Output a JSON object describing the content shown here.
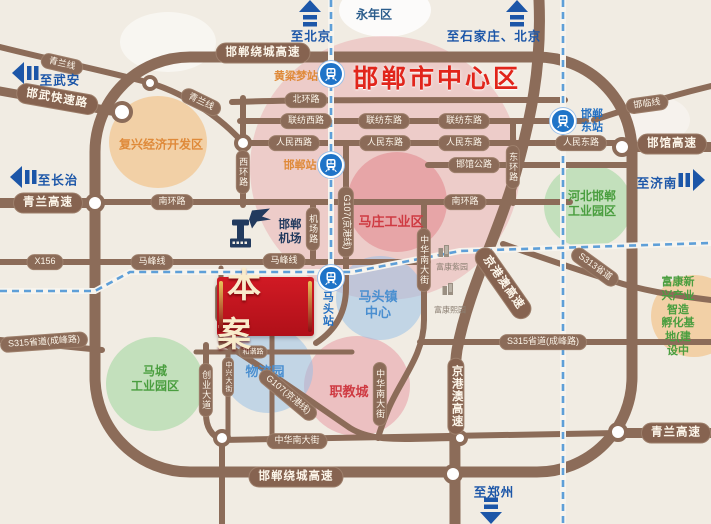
{
  "map": {
    "center_title": "邯郸市中心区",
    "banner": {
      "label": "本案"
    },
    "colors": {
      "road": "#8c6c59",
      "rail_blue": "#5e9fd8",
      "arrow_blue": "#1c56a8",
      "banner_red": "#c01622",
      "title_red": "#e1251b",
      "green_label": "#4a9e3f",
      "orange_label": "#df8a3a",
      "red_label": "#cf3a42",
      "blue_label": "#4a8fd0",
      "navy_label": "#2b5d8c"
    },
    "zones": [
      {
        "name": "yongnian-halo",
        "x": 385,
        "y": 10,
        "rx": 46,
        "ry": 27,
        "c": "rgba(255,255,255,0.8)"
      },
      {
        "name": "city-center",
        "x": 385,
        "y": 168,
        "rx": 135,
        "ry": 132,
        "c": "rgba(230,140,150,0.33)"
      },
      {
        "name": "mazhuang",
        "x": 397,
        "y": 202,
        "rx": 50,
        "ry": 50,
        "c": "rgba(224,112,122,0.42)"
      },
      {
        "name": "zhijiaocheng",
        "x": 357,
        "y": 386,
        "rx": 53,
        "ry": 50,
        "c": "rgba(230,140,150,0.45)"
      },
      {
        "name": "fuxing",
        "x": 158,
        "y": 142,
        "rx": 49,
        "ry": 46,
        "c": "rgba(242,186,116,0.55)"
      },
      {
        "name": "fukang-base",
        "x": 694,
        "y": 316,
        "rx": 43,
        "ry": 41,
        "c": "rgba(242,186,116,0.55)"
      },
      {
        "name": "hebei-park",
        "x": 588,
        "y": 206,
        "rx": 44,
        "ry": 42,
        "c": "rgba(150,212,150,0.5)"
      },
      {
        "name": "macheng-park",
        "x": 155,
        "y": 384,
        "rx": 49,
        "ry": 47,
        "c": "rgba(150,212,150,0.5)"
      },
      {
        "name": "matou-center",
        "x": 380,
        "y": 298,
        "rx": 44,
        "ry": 42,
        "c": "rgba(148,190,232,0.5)"
      },
      {
        "name": "wuliuyuan",
        "x": 268,
        "y": 370,
        "rx": 45,
        "ry": 43,
        "c": "rgba(148,190,232,0.5)"
      }
    ],
    "pills": [
      {
        "t": "邯郸绕城高速",
        "x": 263,
        "y": 53,
        "k": "hw"
      },
      {
        "t": "邯郸绕城高速",
        "x": 296,
        "y": 477,
        "k": "hw"
      },
      {
        "t": "青兰高速",
        "x": 48,
        "y": 203,
        "k": "hw"
      },
      {
        "t": "青兰高速",
        "x": 676,
        "y": 433,
        "k": "hw"
      },
      {
        "t": "邯馆高速",
        "x": 672,
        "y": 144,
        "k": "hw"
      },
      {
        "t": "邯武快速路",
        "x": 57,
        "y": 99,
        "k": "hw",
        "r": 10
      },
      {
        "t": "京港澳高速",
        "x": 503,
        "y": 283,
        "k": "hw",
        "r": 55
      },
      {
        "t": "京港澳高速",
        "x": 456,
        "y": 396,
        "k": "hw",
        "v": 1
      },
      {
        "t": "青兰线",
        "x": 62,
        "y": 64,
        "r": 13
      },
      {
        "t": "青兰线",
        "x": 201,
        "y": 102,
        "r": 26
      },
      {
        "t": "邯临线",
        "x": 647,
        "y": 104,
        "r": -8
      },
      {
        "t": "北环路",
        "x": 306,
        "y": 100
      },
      {
        "t": "联纺西路",
        "x": 306,
        "y": 121
      },
      {
        "t": "联纺东路",
        "x": 384,
        "y": 121
      },
      {
        "t": "联纺东路",
        "x": 464,
        "y": 121
      },
      {
        "t": "人民西路",
        "x": 294,
        "y": 143
      },
      {
        "t": "人民东路",
        "x": 385,
        "y": 143
      },
      {
        "t": "人民东路",
        "x": 464,
        "y": 143
      },
      {
        "t": "人民东路",
        "x": 581,
        "y": 143
      },
      {
        "t": "南环路",
        "x": 172,
        "y": 202
      },
      {
        "t": "南环路",
        "x": 465,
        "y": 202
      },
      {
        "t": "邯馆公路",
        "x": 474,
        "y": 165
      },
      {
        "t": "西环路",
        "x": 243,
        "y": 172,
        "v": 1
      },
      {
        "t": "东环路",
        "x": 513,
        "y": 167,
        "v": 1
      },
      {
        "t": "机场路",
        "x": 313,
        "y": 229,
        "v": 1
      },
      {
        "t": "X156",
        "x": 45,
        "y": 262
      },
      {
        "t": "马峰线",
        "x": 152,
        "y": 262
      },
      {
        "t": "马峰线",
        "x": 284,
        "y": 261
      },
      {
        "t": "G107(京港线)",
        "x": 346,
        "y": 222,
        "r": 90
      },
      {
        "t": "G107(京港线)",
        "x": 288,
        "y": 395,
        "r": 40
      },
      {
        "t": "中华南大街",
        "x": 424,
        "y": 260,
        "v": 1
      },
      {
        "t": "中华南大街",
        "x": 380,
        "y": 394,
        "v": 1
      },
      {
        "t": "中华南大街",
        "x": 297,
        "y": 441
      },
      {
        "t": "S313省道",
        "x": 595,
        "y": 267,
        "r": 36
      },
      {
        "t": "S315省道(成峰路)",
        "x": 44,
        "y": 342,
        "r": -4
      },
      {
        "t": "S315省道(成峰路)",
        "x": 543,
        "y": 342
      },
      {
        "t": "创业大道",
        "x": 206,
        "y": 390,
        "v": 1
      },
      {
        "t": "中兴大街",
        "x": 221,
        "y": 303,
        "k": "sm",
        "v": 1
      },
      {
        "t": "中兴大街",
        "x": 228,
        "y": 377,
        "k": "sm",
        "v": 1
      },
      {
        "t": "和谐路",
        "x": 253,
        "y": 352,
        "k": "sm"
      }
    ],
    "areas": [
      {
        "t": "永年区",
        "x": 374,
        "y": 15,
        "c": "#2b5d8c",
        "s": 12
      },
      {
        "t": "复兴经济开发区",
        "x": 161,
        "y": 145,
        "c": "#df8a3a",
        "s": 12
      },
      {
        "t": "马庄工业区",
        "x": 391,
        "y": 222,
        "c": "#cf3a42",
        "s": 13
      },
      {
        "t": "河北邯郸\n工业园区",
        "x": 592,
        "y": 204,
        "c": "#4a9e3f",
        "s": 12
      },
      {
        "t": "马城\n工业园区",
        "x": 155,
        "y": 379,
        "c": "#4a9e3f",
        "s": 12
      },
      {
        "t": "马头镇\n中心",
        "x": 378,
        "y": 305,
        "c": "#4a8fd0",
        "s": 13
      },
      {
        "t": "物流园",
        "x": 265,
        "y": 372,
        "c": "#4a8fd0",
        "s": 13
      },
      {
        "t": "职教城",
        "x": 349,
        "y": 392,
        "c": "#cf3a42",
        "s": 13
      },
      {
        "t": "富康新兴产业智造\n孵化基地(建设中",
        "x": 678,
        "y": 317,
        "c": "#4a9e3f",
        "s": 11
      }
    ],
    "stations": [
      {
        "name": "黄粱梦站",
        "x": 331,
        "y": 74,
        "label_x": 296,
        "label_y": 77,
        "c": "#df8a3a",
        "v": 0
      },
      {
        "name": "邯郸站",
        "x": 331,
        "y": 165,
        "label_x": 300,
        "label_y": 166,
        "c": "#df8a3a",
        "v": 0
      },
      {
        "name": "邯郸\n东站",
        "x": 563,
        "y": 121,
        "label_x": 592,
        "label_y": 121,
        "c": "#2470c2",
        "v": 0
      },
      {
        "name": "马头站",
        "x": 331,
        "y": 278,
        "label_x": 327,
        "label_y": 309,
        "c": "#2470c2",
        "v": 1
      }
    ],
    "airport": {
      "label": "邯郸\n机场",
      "icon_x": 250,
      "icon_y": 231,
      "label_x": 290,
      "label_y": 233
    },
    "arrows": [
      {
        "t": "至北京",
        "dir": "up",
        "x": 310,
        "y": 14,
        "tx": 311,
        "ty": 35
      },
      {
        "t": "至石家庄、北京",
        "dir": "up",
        "x": 517,
        "y": 14,
        "tx": 494,
        "ty": 35
      },
      {
        "t": "至武安",
        "dir": "left",
        "x": 26,
        "y": 73,
        "tx": 60,
        "ty": 79
      },
      {
        "t": "至长治",
        "dir": "left",
        "x": 24,
        "y": 177,
        "tx": 58,
        "ty": 179
      },
      {
        "t": "至济南",
        "dir": "right",
        "x": 691,
        "y": 180,
        "tx": 657,
        "ty": 182
      },
      {
        "t": "至郑州",
        "dir": "down",
        "x": 491,
        "y": 510,
        "tx": 494,
        "ty": 491
      }
    ],
    "pois": [
      {
        "t": "富康紫园",
        "x": 452,
        "y": 267,
        "icon_x": 444,
        "icon_y": 259
      },
      {
        "t": "富康熙园",
        "x": 450,
        "y": 310,
        "icon_x": 448,
        "icon_y": 297
      }
    ]
  }
}
